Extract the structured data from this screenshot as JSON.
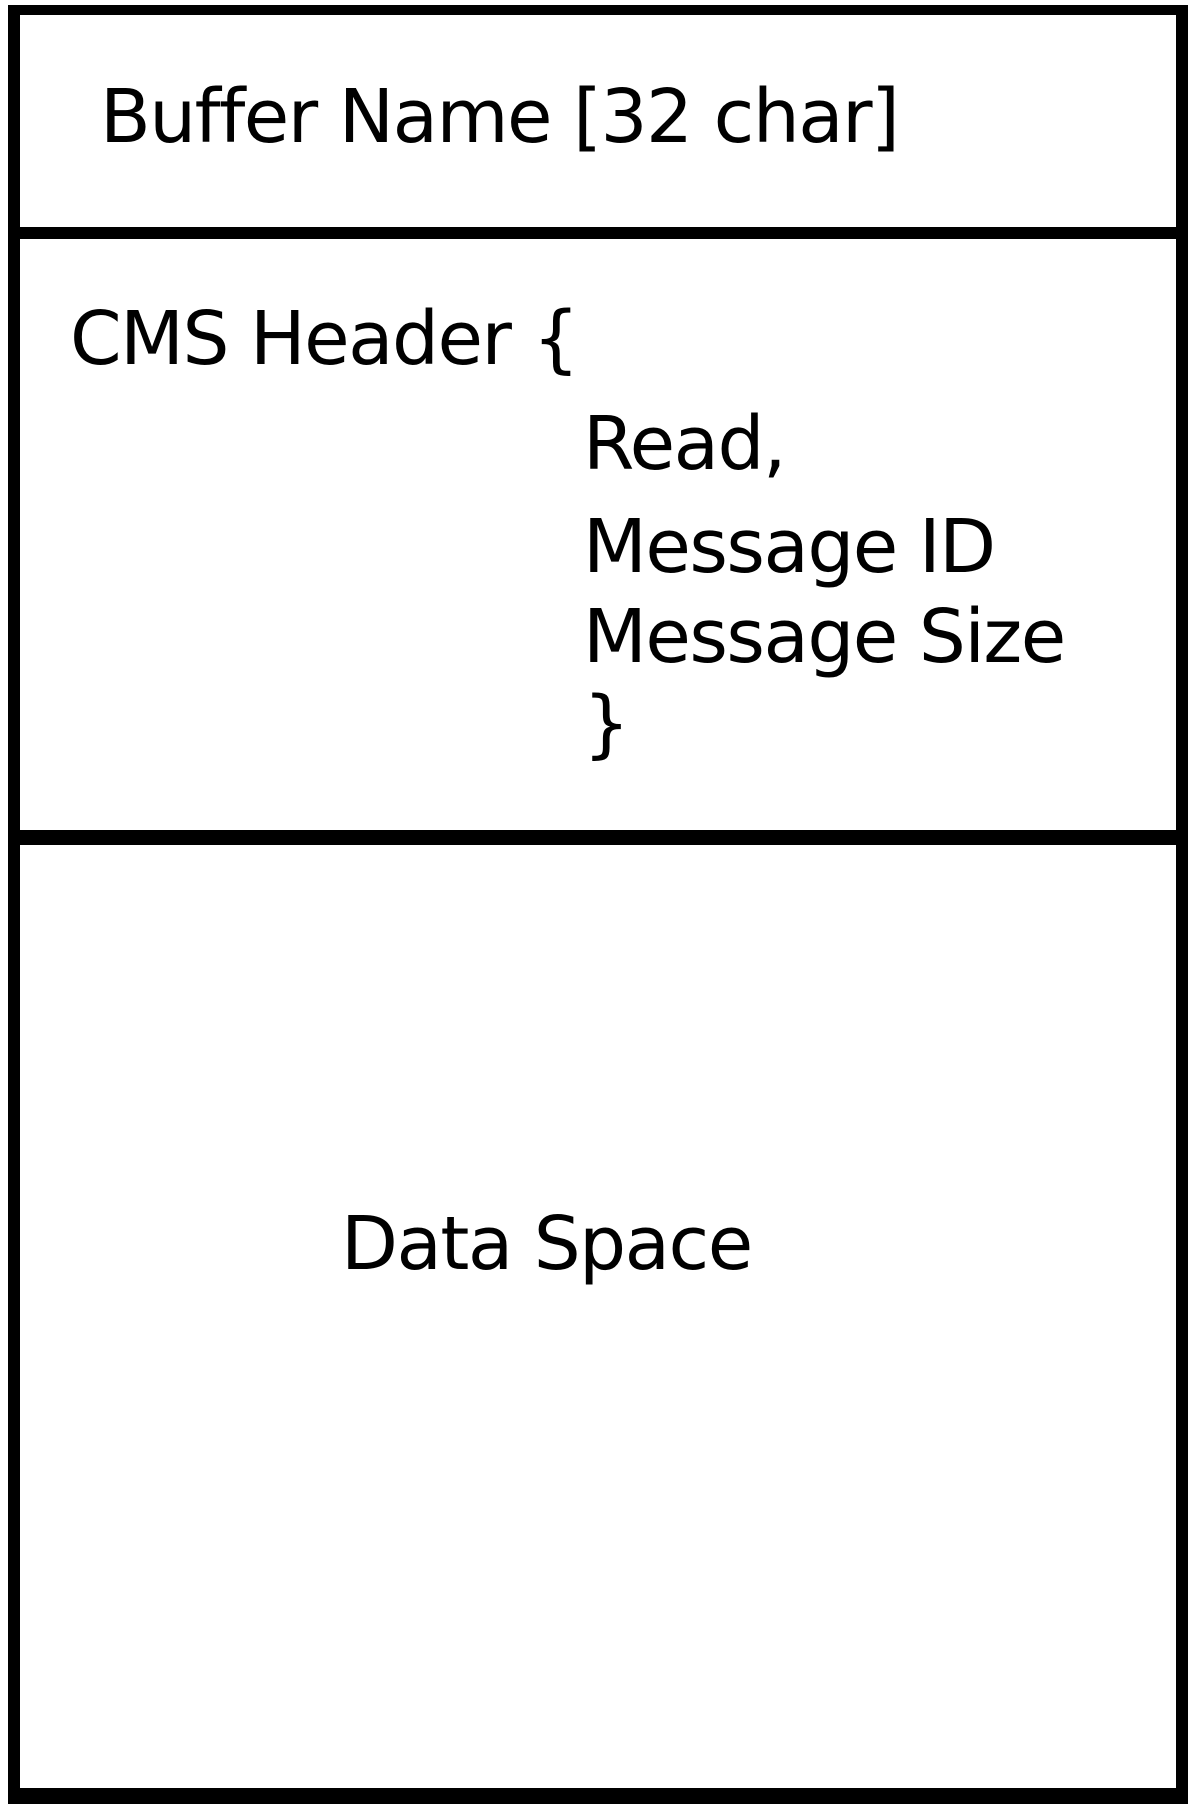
{
  "diagram": {
    "buffer_name_label": "Buffer Name [32 char]",
    "cms_header": {
      "open_label": "CMS Header {",
      "fields": [
        "Read,",
        "Message ID",
        "Message Size"
      ],
      "close_label": "}"
    },
    "data_space_label": "Data Space"
  },
  "colors": {
    "line": "#000000",
    "background": "#ffffff",
    "text": "#000000"
  }
}
